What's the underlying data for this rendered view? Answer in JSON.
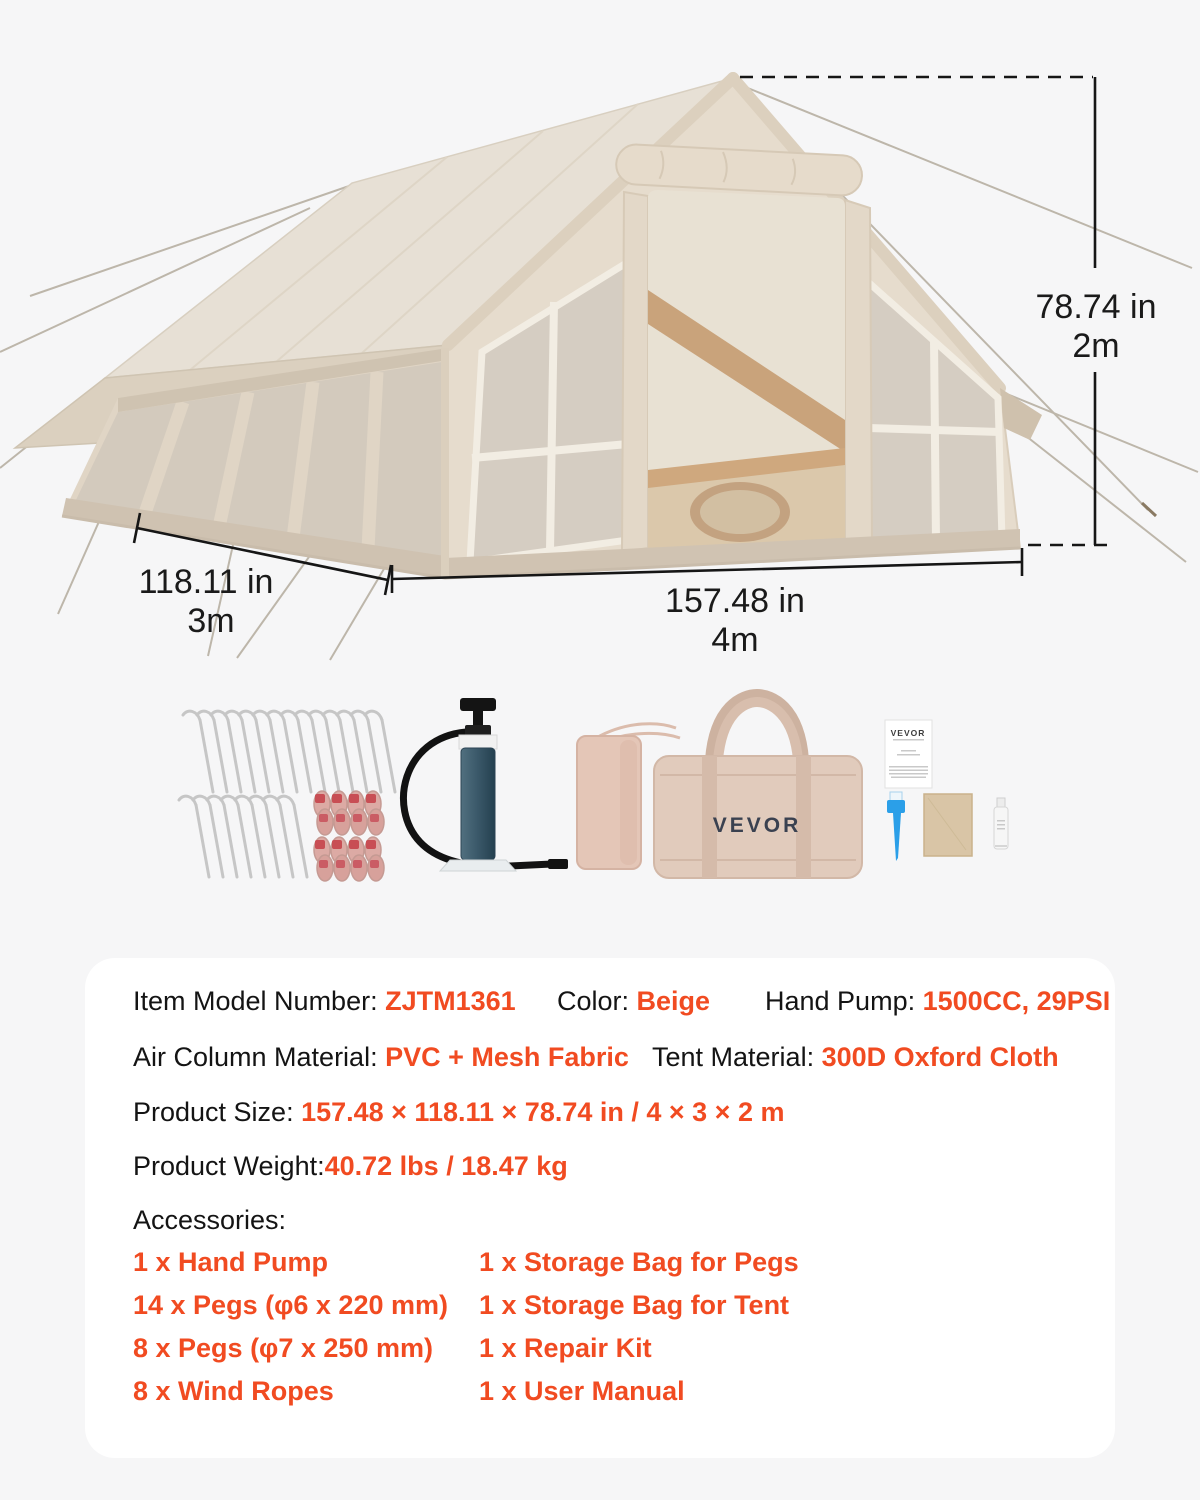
{
  "page": {
    "background": "#f6f6f7",
    "accent": "#f14b21"
  },
  "dimensions": {
    "height_in": "78.74 in",
    "height_m": "2m",
    "depth_in": "118.11 in",
    "depth_m": "3m",
    "width_in": "157.48 in",
    "width_m": "4m"
  },
  "accessories_image": {
    "tent_bag_logo": "VEVOR",
    "manual_logo": "VEVOR"
  },
  "specs": {
    "item_model": {
      "label": "Item Model Number: ",
      "value": "ZJTM1361"
    },
    "color": {
      "label": "Color: ",
      "value": "Beige"
    },
    "hand_pump": {
      "label": "Hand Pump: ",
      "value": "1500CC, 29PSI"
    },
    "air_column": {
      "label": "Air Column Material: ",
      "value": "PVC + Mesh Fabric"
    },
    "tent_material": {
      "label": "Tent Material: ",
      "value": "300D Oxford Cloth"
    },
    "product_size": {
      "label": "Product Size: ",
      "value": "157.48 × 118.11 × 78.74 in / 4 × 3 × 2 m"
    },
    "product_weight": {
      "label": "Product Weight:",
      "value": "40.72 lbs / 18.47 kg"
    },
    "accessories_label": "Accessories:",
    "accessories_left": [
      "1 x Hand Pump",
      "14 x Pegs (φ6 x 220 mm)",
      "8 x Pegs (φ7 x 250 mm)",
      "8 x Wind Ropes"
    ],
    "accessories_right": [
      "1 x Storage Bag for Pegs",
      "1 x Storage Bag for Tent",
      "1 x Repair Kit",
      "1 x User Manual"
    ]
  }
}
